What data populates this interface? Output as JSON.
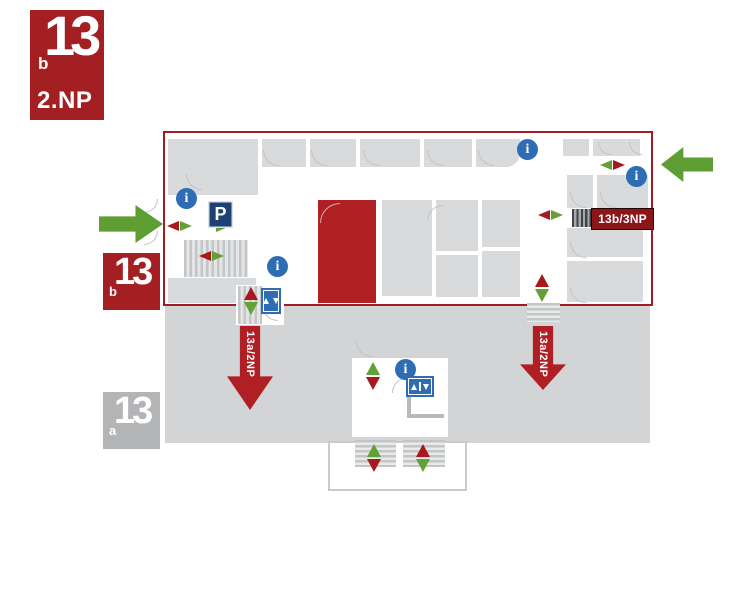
{
  "colors": {
    "brand_red": "#a31f22",
    "outline_red": "#a01d23",
    "room_red": "#b01f24",
    "label_red": "#8c1519",
    "green": "#5f9e33",
    "marker_red": "#a8191d",
    "marker_green": "#62a135",
    "info_blue": "#2e6db4",
    "parking_navy": "#1f4074",
    "room_gray": "#d9dadb",
    "area_gray": "#d3d4d5",
    "badge_gray": "#b3b4b6"
  },
  "badges": {
    "main": {
      "number": "13",
      "letter": "b",
      "floor": "2.NP"
    },
    "wing_13b": {
      "number": "13",
      "letter": "b"
    },
    "wing_13a": {
      "number": "13",
      "letter": "a"
    }
  },
  "plan": {
    "stair_labels": {
      "to_3np": "13b/3NP",
      "left_down": "13a/2NP",
      "right_down": "13a/2NP"
    },
    "glyphs": {
      "info": "i",
      "parking": "P"
    },
    "rooms": [
      {
        "x": 168,
        "y": 139,
        "w": 90,
        "h": 56
      },
      {
        "x": 262,
        "y": 139,
        "w": 44,
        "h": 28
      },
      {
        "x": 310,
        "y": 139,
        "w": 46,
        "h": 28
      },
      {
        "x": 360,
        "y": 139,
        "w": 60,
        "h": 28
      },
      {
        "x": 424,
        "y": 139,
        "w": 48,
        "h": 28
      },
      {
        "x": 476,
        "y": 139,
        "w": 44,
        "h": 28,
        "r": "0 0 14px 0"
      },
      {
        "x": 563,
        "y": 139,
        "w": 26,
        "h": 17
      },
      {
        "x": 593,
        "y": 139,
        "w": 47,
        "h": 17
      },
      {
        "x": 567,
        "y": 175,
        "w": 26,
        "h": 33
      },
      {
        "x": 597,
        "y": 175,
        "w": 51,
        "h": 33
      },
      {
        "x": 567,
        "y": 228,
        "w": 76,
        "h": 29
      },
      {
        "x": 567,
        "y": 261,
        "w": 76,
        "h": 41
      },
      {
        "x": 382,
        "y": 200,
        "w": 50,
        "h": 96
      },
      {
        "x": 436,
        "y": 200,
        "w": 42,
        "h": 51
      },
      {
        "x": 436,
        "y": 255,
        "w": 42,
        "h": 42
      },
      {
        "x": 482,
        "y": 200,
        "w": 38,
        "h": 47
      },
      {
        "x": 482,
        "y": 251,
        "w": 38,
        "h": 46
      },
      {
        "x": 168,
        "y": 278,
        "w": 88,
        "h": 25
      },
      {
        "x": 236,
        "y": 285,
        "w": 48,
        "h": 40,
        "fill": "#ffffff"
      }
    ],
    "stairs": [
      {
        "x": 184,
        "y": 240,
        "w": 64,
        "h": 37,
        "k": "v"
      },
      {
        "x": 238,
        "y": 286,
        "w": 24,
        "h": 38,
        "k": "v"
      },
      {
        "x": 572,
        "y": 209,
        "w": 19,
        "h": 18,
        "k": "dark"
      },
      {
        "x": 527,
        "y": 303,
        "w": 33,
        "h": 19,
        "k": "h"
      },
      {
        "x": 355,
        "y": 440,
        "w": 41,
        "h": 27,
        "k": "h"
      },
      {
        "x": 403,
        "y": 440,
        "w": 42,
        "h": 27,
        "k": "h"
      }
    ],
    "arcs": [
      {
        "x": 263,
        "y": 150,
        "c": "bl"
      },
      {
        "x": 311,
        "y": 150,
        "c": "bl"
      },
      {
        "x": 363,
        "y": 150,
        "c": "bl"
      },
      {
        "x": 427,
        "y": 150,
        "c": "bl"
      },
      {
        "x": 478,
        "y": 150,
        "c": "bl"
      },
      {
        "x": 186,
        "y": 174,
        "c": "bl"
      },
      {
        "x": 320,
        "y": 203,
        "c": "tl",
        "red": true,
        "s": 20
      },
      {
        "x": 598,
        "y": 142,
        "c": "bl",
        "s": 13
      },
      {
        "x": 629,
        "y": 142,
        "c": "bl",
        "s": 13
      },
      {
        "x": 570,
        "y": 192,
        "c": "bl"
      },
      {
        "x": 600,
        "y": 192,
        "c": "bl"
      },
      {
        "x": 570,
        "y": 242,
        "c": "bl"
      },
      {
        "x": 570,
        "y": 287,
        "c": "bl"
      },
      {
        "x": 427,
        "y": 205,
        "c": "tl"
      },
      {
        "x": 144,
        "y": 199,
        "c": "br",
        "s": 14
      },
      {
        "x": 144,
        "y": 231,
        "c": "br",
        "s": 14
      },
      {
        "x": 392,
        "y": 377,
        "c": "tl"
      },
      {
        "x": 356,
        "y": 341,
        "c": "bl"
      },
      {
        "x": 262,
        "y": 305,
        "c": "bl"
      }
    ],
    "markers": [
      {
        "x": 167,
        "y": 221,
        "o": "h",
        "a": "red",
        "b": "green"
      },
      {
        "x": 216,
        "y": 222,
        "o": "h",
        "a": null,
        "b": "green"
      },
      {
        "x": 199,
        "y": 251,
        "o": "h",
        "a": "red",
        "b": "green"
      },
      {
        "x": 244,
        "y": 287,
        "o": "v",
        "a": "red",
        "b": "green"
      },
      {
        "x": 535,
        "y": 274,
        "o": "v",
        "a": "red",
        "b": "green"
      },
      {
        "x": 538,
        "y": 210,
        "o": "h",
        "a": "red",
        "b": "green"
      },
      {
        "x": 600,
        "y": 160,
        "o": "h",
        "a": "green",
        "b": "red"
      },
      {
        "x": 366,
        "y": 362,
        "o": "v",
        "a": "green",
        "b": "red"
      },
      {
        "x": 367,
        "y": 444,
        "o": "v",
        "a": "green",
        "b": "red"
      },
      {
        "x": 416,
        "y": 444,
        "o": "v",
        "a": "red",
        "b": "green"
      }
    ],
    "info_icons": [
      {
        "x": 176,
        "y": 188
      },
      {
        "x": 267,
        "y": 256
      },
      {
        "x": 517,
        "y": 139
      },
      {
        "x": 626,
        "y": 166
      },
      {
        "x": 395,
        "y": 359
      }
    ]
  }
}
